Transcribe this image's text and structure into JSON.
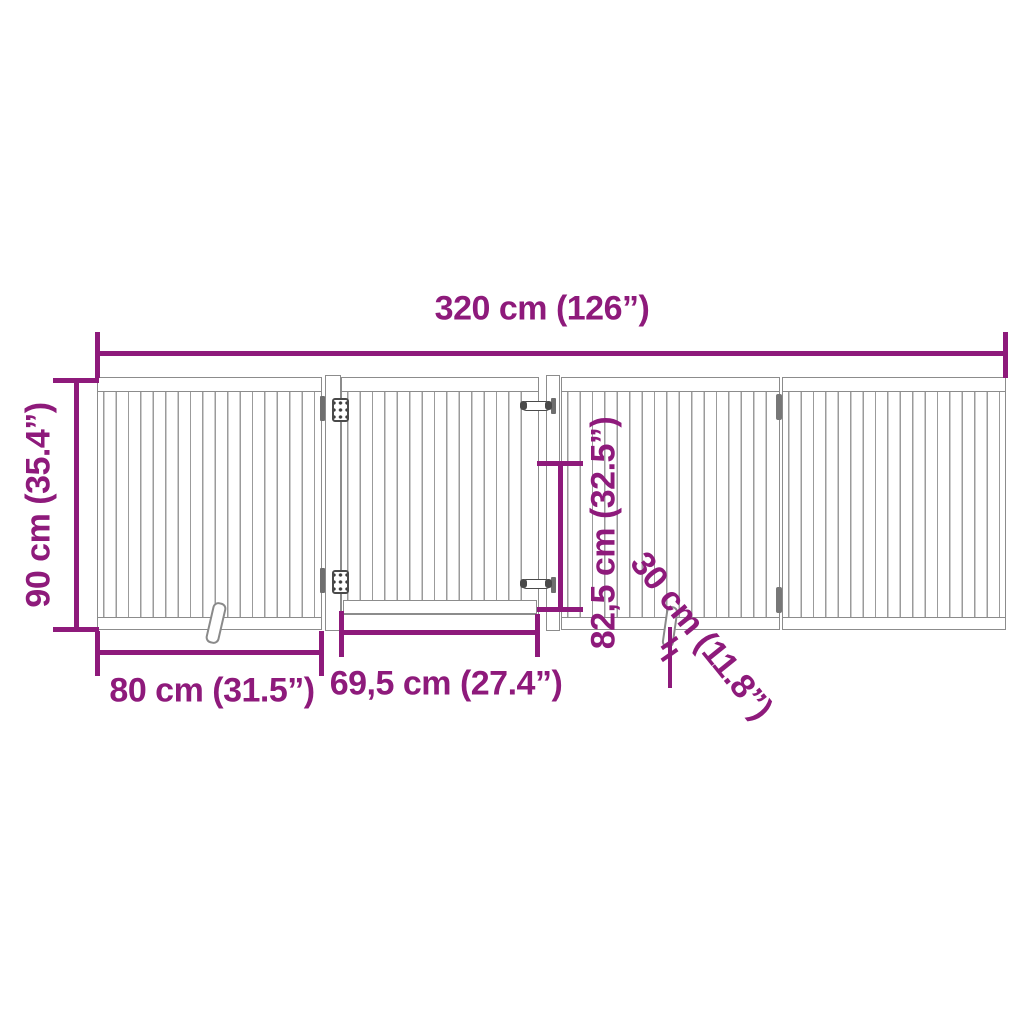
{
  "dimension_labels": {
    "total_width": "320 cm (126”)",
    "total_height": "90 cm (35.4”)",
    "panel_width": "80 cm (31.5”)",
    "door_width": "69,5 cm (27.4”)",
    "door_height": "82,5 cm (32.5”)",
    "support_foot_length": "30 cm (11.8”)"
  },
  "colors": {
    "dimension_accent": "#8E1A7B",
    "gate_outline": "#8C8C8C",
    "hardware": "#4A4A4A",
    "background": "#FFFFFF"
  },
  "components": {
    "panels": 4,
    "door": "center gate door with two latch pins",
    "hinges": "two hinges on door post, one folding joint between right panels",
    "support_feet": 2
  }
}
